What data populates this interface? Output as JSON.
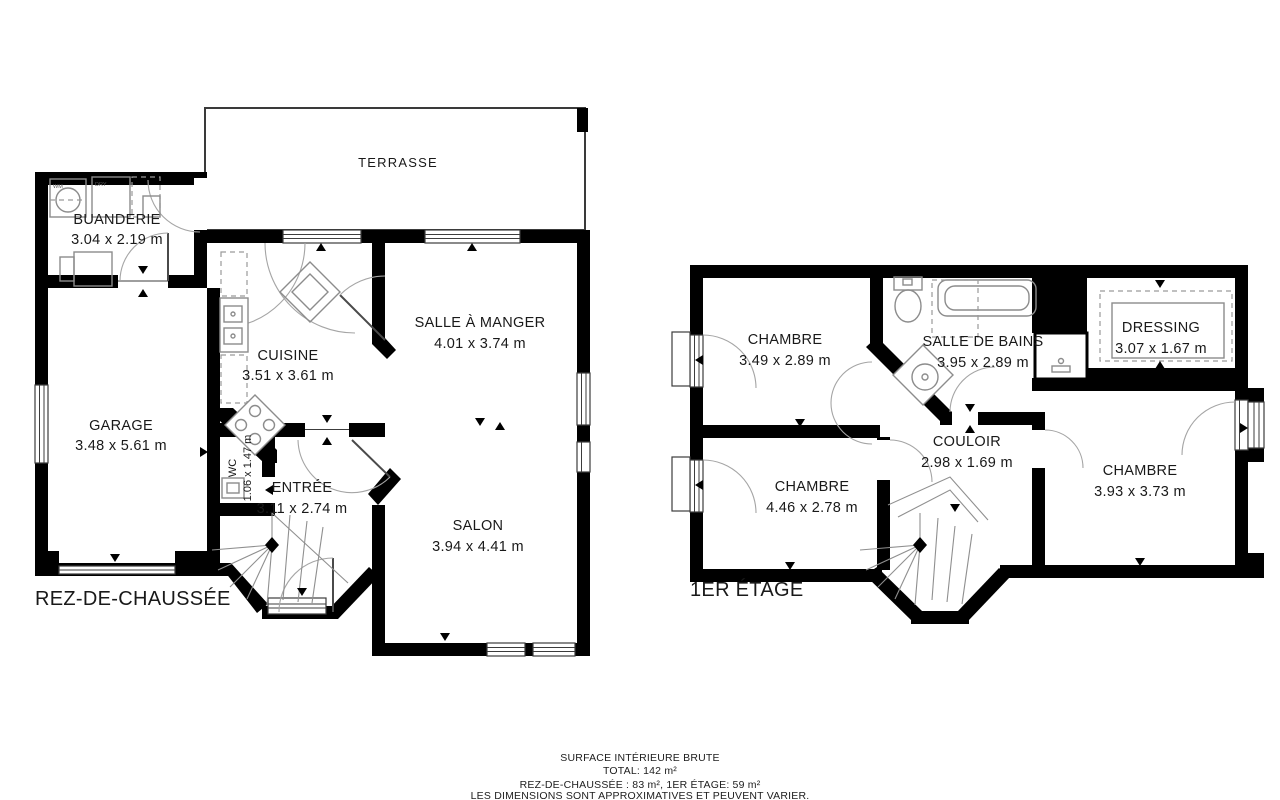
{
  "meta": {
    "background": "#ffffff",
    "wall_color": "#000000",
    "fixture_color": "#8c8c8c",
    "text_color": "#191919"
  },
  "ground_floor": {
    "floor_label": "REZ-DE-CHAUSSÉE",
    "rooms": {
      "terrasse": {
        "name": "TERRASSE",
        "dims": ""
      },
      "buanderie": {
        "name": "BUANDERIE",
        "dims": "3.04 x 2.19 m"
      },
      "garage": {
        "name": "GARAGE",
        "dims": "3.48 x 5.61 m"
      },
      "cuisine": {
        "name": "CUISINE",
        "dims": "3.51 x 3.61 m"
      },
      "salle_a_manger": {
        "name": "SALLE À MANGER",
        "dims": "4.01 x 3.74 m"
      },
      "wc": {
        "name": "WC",
        "dims": "1.06 x 1.47 m"
      },
      "entree": {
        "name": "ENTRÉE",
        "dims": "3.11 x 2.74 m"
      },
      "salon": {
        "name": "SALON",
        "dims": "3.94 x 4.41 m"
      }
    },
    "appliances": {
      "washer": "WM",
      "dryer": "DRY"
    }
  },
  "first_floor": {
    "floor_label": "1ER ÉTAGE",
    "rooms": {
      "chambre_1": {
        "name": "CHAMBRE",
        "dims": "3.49 x 2.89 m"
      },
      "salle_de_bains": {
        "name": "SALLE DE BAINS",
        "dims": "3.95 x 2.89 m"
      },
      "dressing": {
        "name": "DRESSING",
        "dims": "3.07 x 1.67 m"
      },
      "couloir": {
        "name": "COULOIR",
        "dims": "2.98 x 1.69 m"
      },
      "chambre_2": {
        "name": "CHAMBRE",
        "dims": "4.46 x 2.78 m"
      },
      "chambre_3": {
        "name": "CHAMBRE",
        "dims": "3.93 x 3.73 m"
      }
    }
  },
  "footer": {
    "line1": "SURFACE INTÉRIEURE BRUTE",
    "line2": "TOTAL: 142 m²",
    "line3": "REZ-DE-CHAUSSÉE : 83 m², 1ER ÉTAGE: 59 m²",
    "line4": "LES DIMENSIONS SONT APPROXIMATIVES ET PEUVENT VARIER."
  }
}
